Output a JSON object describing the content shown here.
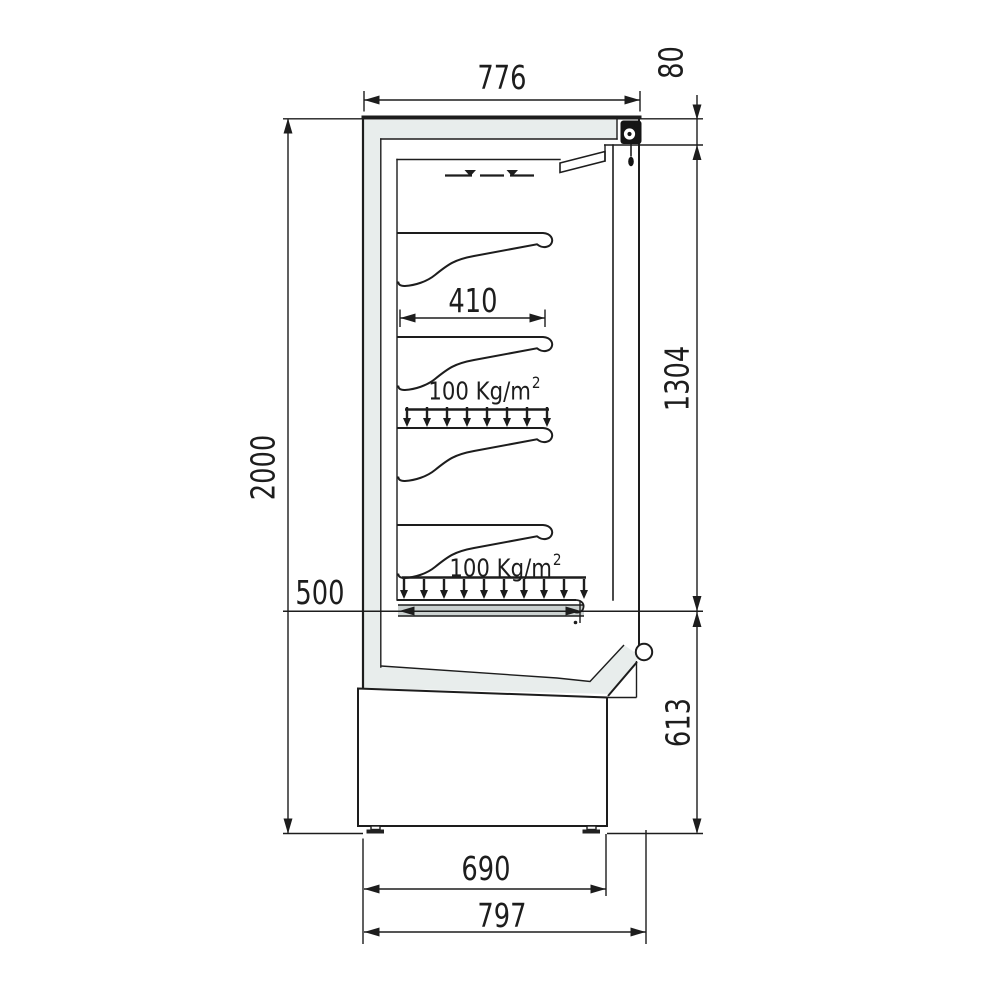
{
  "dimensions": {
    "top_width": "776",
    "canopy_height": "80",
    "total_height": "2000",
    "shelf_depth": "410",
    "opening_height": "1304",
    "deck_depth": "500",
    "base_height": "613",
    "base_width": "690",
    "bottom_width": "797"
  },
  "load_rating": {
    "text": "100 Kg/m",
    "exponent": "2"
  },
  "colors": {
    "line": "#1d1d1d",
    "insulation_gray": "#e8edec",
    "deck_gray": "#ccd2d1"
  }
}
